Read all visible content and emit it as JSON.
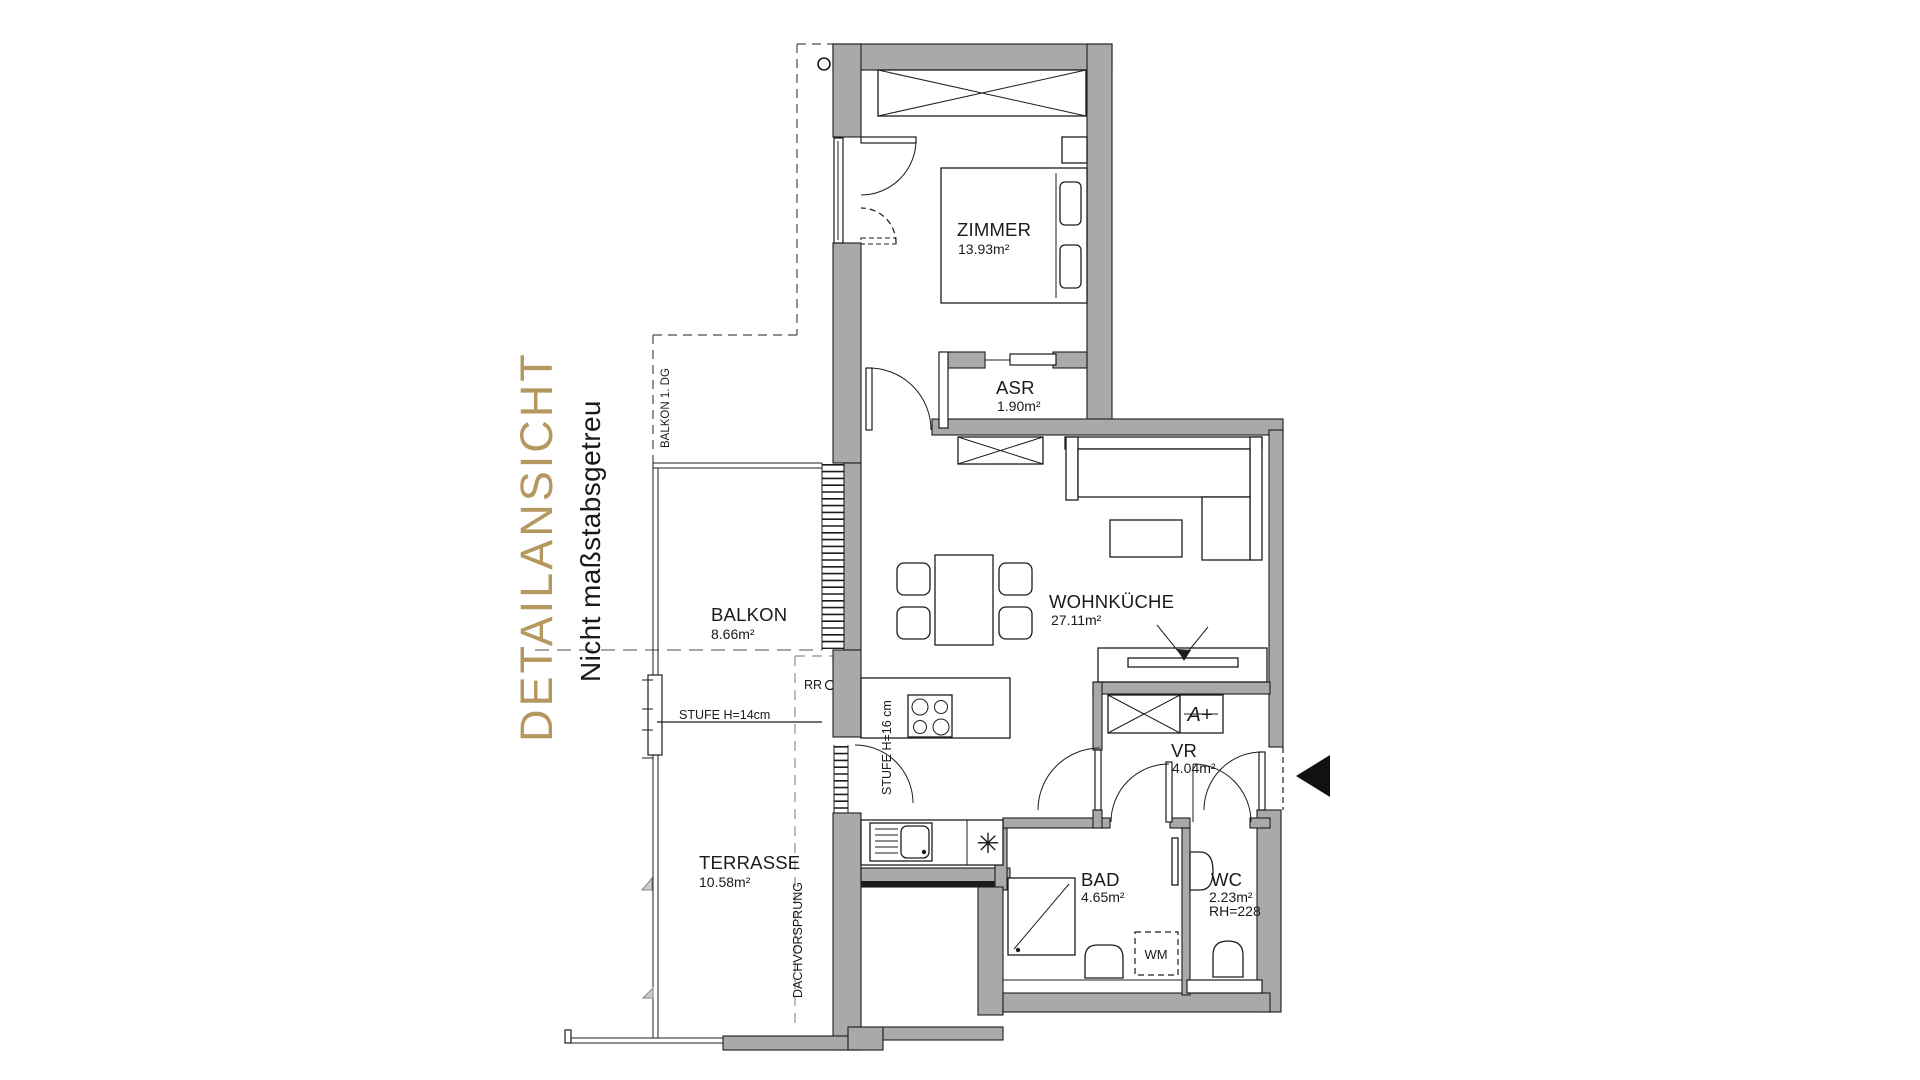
{
  "title": {
    "main": "DETAILANSICHT",
    "subtitle": "Nicht maßstabsgetreu"
  },
  "colors": {
    "accent_gold": "#b59760",
    "wall_gray": "#a9a9a9",
    "line_black": "#1c1c1c"
  },
  "rooms": {
    "zimmer": {
      "name": "ZIMMER",
      "area": "13.93m²"
    },
    "asr": {
      "name": "ASR",
      "area": "1.90m²"
    },
    "wohnkueche": {
      "name": "WOHNKÜCHE",
      "area": "27.11m²"
    },
    "balkon": {
      "name": "BALKON",
      "area": "8.66m²"
    },
    "terrasse": {
      "name": "TERRASSE",
      "area": "10.58m²"
    },
    "vr": {
      "name": "VR",
      "area": "4.04m²"
    },
    "bad": {
      "name": "BAD",
      "area": "4.65m²"
    },
    "wc": {
      "name": "WC",
      "area": "2.23m²",
      "height_note": "RH=228"
    }
  },
  "annotations": {
    "balkon_above": "BALKON 1. DG",
    "step_terrace": "STUFE H=14cm",
    "step_kitchen": "STUFE H=16 cm",
    "rain_pipe": "RR",
    "roof_overhang": "DACHVORSPRUNG",
    "washing_machine": "WM",
    "boiler": "A+",
    "dishwasher_symbol": "✳"
  }
}
